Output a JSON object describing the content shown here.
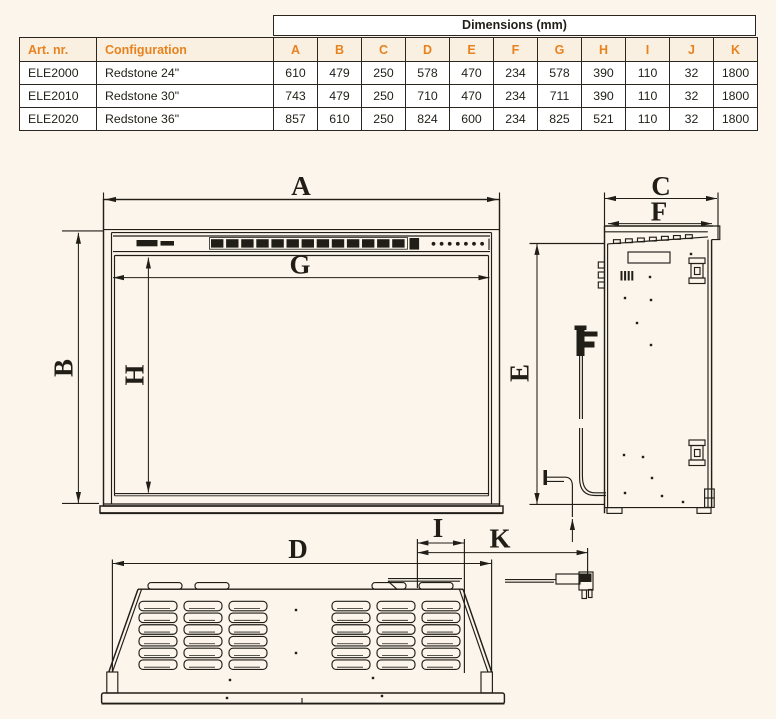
{
  "page": {
    "background": "#fbf5eb",
    "ink": "#211e18",
    "accent": "#e8821e",
    "header_bg": "#faf0e1",
    "cell_bg": "#ffffff",
    "border_color": "#2b2620"
  },
  "table": {
    "group_header": "Dimensions (mm)",
    "columns": [
      "Art. nr.",
      "Configuration",
      "A",
      "B",
      "C",
      "D",
      "E",
      "F",
      "G",
      "H",
      "I",
      "J",
      "K"
    ],
    "rows": [
      {
        "art_nr": "ELE2000",
        "configuration": "Redstone 24\"",
        "values": [
          "610",
          "479",
          "250",
          "578",
          "470",
          "234",
          "578",
          "390",
          "110",
          "32",
          "1800"
        ]
      },
      {
        "art_nr": "ELE2010",
        "configuration": "Redstone 30\"",
        "values": [
          "743",
          "479",
          "250",
          "710",
          "470",
          "234",
          "711",
          "390",
          "110",
          "32",
          "1800"
        ]
      },
      {
        "art_nr": "ELE2020",
        "configuration": "Redstone 36\"",
        "values": [
          "857",
          "610",
          "250",
          "824",
          "600",
          "234",
          "825",
          "521",
          "110",
          "32",
          "1800"
        ]
      }
    ]
  },
  "drawing": {
    "front_view": {
      "overall_width": "A",
      "overall_height": "B",
      "opening_width": "G",
      "opening_height": "H"
    },
    "side_view": {
      "overall_depth": "C",
      "insert_depth": "F",
      "body_height": "E"
    },
    "bottom_view": {
      "body_width": "D",
      "cord_offset": "I",
      "cord_length": "K"
    }
  }
}
